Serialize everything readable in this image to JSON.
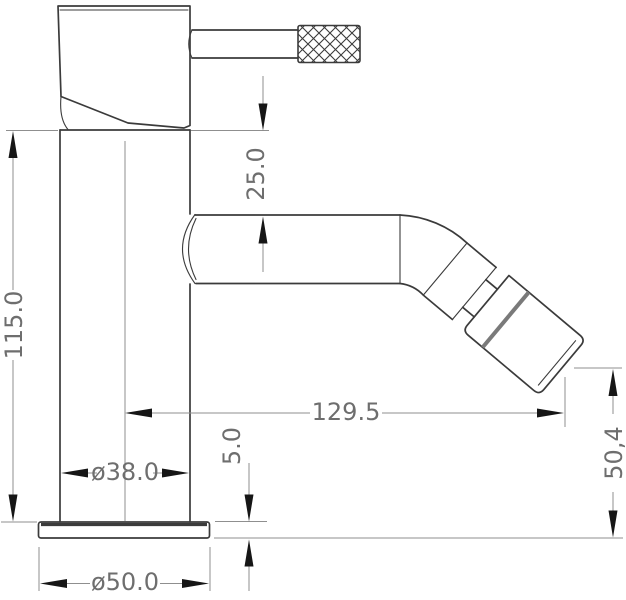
{
  "drawing": {
    "subject": "bidet-tap-side-elevation-technical-drawing",
    "colors": {
      "outline": "#3b3b3b",
      "dim-line": "#8f8f8f",
      "dim-text": "#6e6e6e",
      "arrow": "#161616",
      "band": "#7a7a7a",
      "background": "#ffffff"
    },
    "dims": {
      "spout_drop": {
        "label": "25.0"
      },
      "total_height": {
        "label": "115.0"
      },
      "spout_reach": {
        "label": "129.5"
      },
      "base_thickness": {
        "label": "5.0"
      },
      "outlet_height": {
        "label": "50,4"
      },
      "body_diameter": {
        "label": "ø38.0"
      },
      "base_diameter": {
        "label": "ø50.0"
      }
    }
  }
}
